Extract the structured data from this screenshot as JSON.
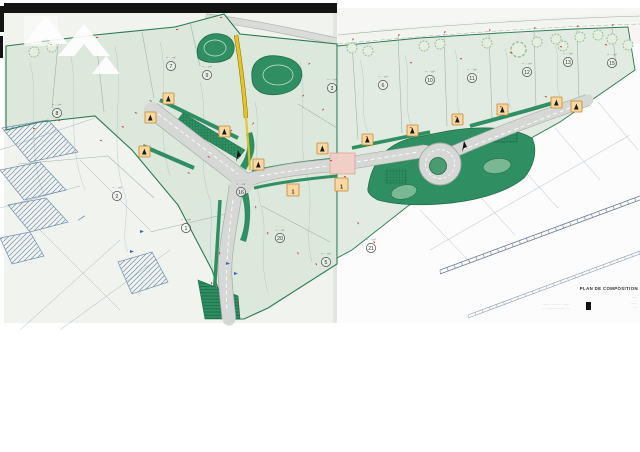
{
  "document": {
    "kind_label": "scanned subdivision site plan"
  },
  "map": {
    "road_label_top": "·· ······ ·· ···· ··",
    "marker_one_label": "1",
    "lots": [
      {
        "number": "7",
        "area": "≈ ··· m²"
      },
      {
        "number": "9",
        "area": "≈ ··· m²"
      },
      {
        "number": "8",
        "area": "≈ ··· m²"
      },
      {
        "number": "2",
        "area": "≈ ··· m²"
      },
      {
        "number": "1",
        "area": "≈ ··· m²"
      },
      {
        "number": "16",
        "area": "···· ····· ·····",
        "area2": "≈ ··· m²"
      },
      {
        "number": "20",
        "area": "···· ···· ··",
        "area2": "≈ ··· m²"
      },
      {
        "number": "5",
        "area": "≈ ··· m²"
      },
      {
        "number": "3",
        "area": "≈ ··· m²"
      },
      {
        "number": "6",
        "area": "≈ ··· m²"
      },
      {
        "number": "10",
        "area": "≈ ··· m²"
      },
      {
        "number": "11",
        "area": "≈ ··· m²"
      },
      {
        "number": "12",
        "area": "≈ ··· m²"
      },
      {
        "number": "13",
        "area": "≈ ··· m²"
      },
      {
        "number": "15",
        "area": "≈ ··· m²"
      },
      {
        "number": "21",
        "area": "≈ ··· m²"
      }
    ]
  },
  "titleblock": {
    "title": "PLAN DE COMPOSITION",
    "stamp_line1": "········ ·· ······· · ········",
    "stamp_line2": "··· ···· ········ ·· ···· ·····",
    "margin_line1": "·······",
    "margin_line2": "·········",
    "margin_line3": "······"
  },
  "colors": {
    "site_green": "#dde8dd",
    "vegetation_green": "#2f8f63",
    "road_gray": "#d5d8d4",
    "path_yellow": "#e6c31d",
    "marker_orange": "#f6d9a2",
    "marker_border": "#c8862f",
    "crossing_pink": "#f2cfc6",
    "contour_blue": "#7fa8c0",
    "dimension_red": "#c23b28",
    "hatch_blue": "#5b7fa6"
  }
}
